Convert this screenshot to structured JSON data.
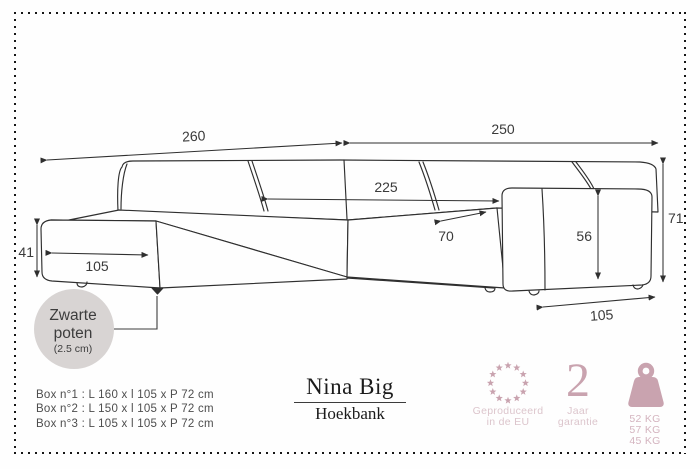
{
  "diagram": {
    "dimensions": {
      "width_left": "260",
      "width_right": "250",
      "inner_width": "225",
      "seat_depth": "70",
      "arm_inner_height": "56",
      "total_height": "71",
      "chaise_height": "41",
      "chaise_width": "105",
      "arm_width": "105"
    },
    "legs_note": {
      "line1": "Zwarte",
      "line2": "poten",
      "line3": "(2.5 cm)"
    }
  },
  "footer": {
    "boxes": [
      "Box n°1 : L 160 x l 105 x P 72 cm",
      "Box n°2 : L 150 x l 105 x P 72 cm",
      "Box n°3 : L 105 x l 105 x P 72 cm"
    ],
    "product": {
      "name": "Nina Big",
      "type": "Hoekbank"
    },
    "badges": {
      "eu": {
        "label_line1": "Geproduceerd",
        "label_line2": "in de EU"
      },
      "warranty": {
        "value": "2",
        "label_line1": "Jaar",
        "label_line2": "garantie"
      },
      "weights": [
        "52 KG",
        "57 KG",
        "45 KG"
      ]
    }
  },
  "colors": {
    "line": "#2f2f2f",
    "dim_text": "#3a3a3a",
    "accent_pink": "#c9a3af",
    "accent_pink_light": "#dcc5cc",
    "legs_circle": "#d8d4d3"
  }
}
